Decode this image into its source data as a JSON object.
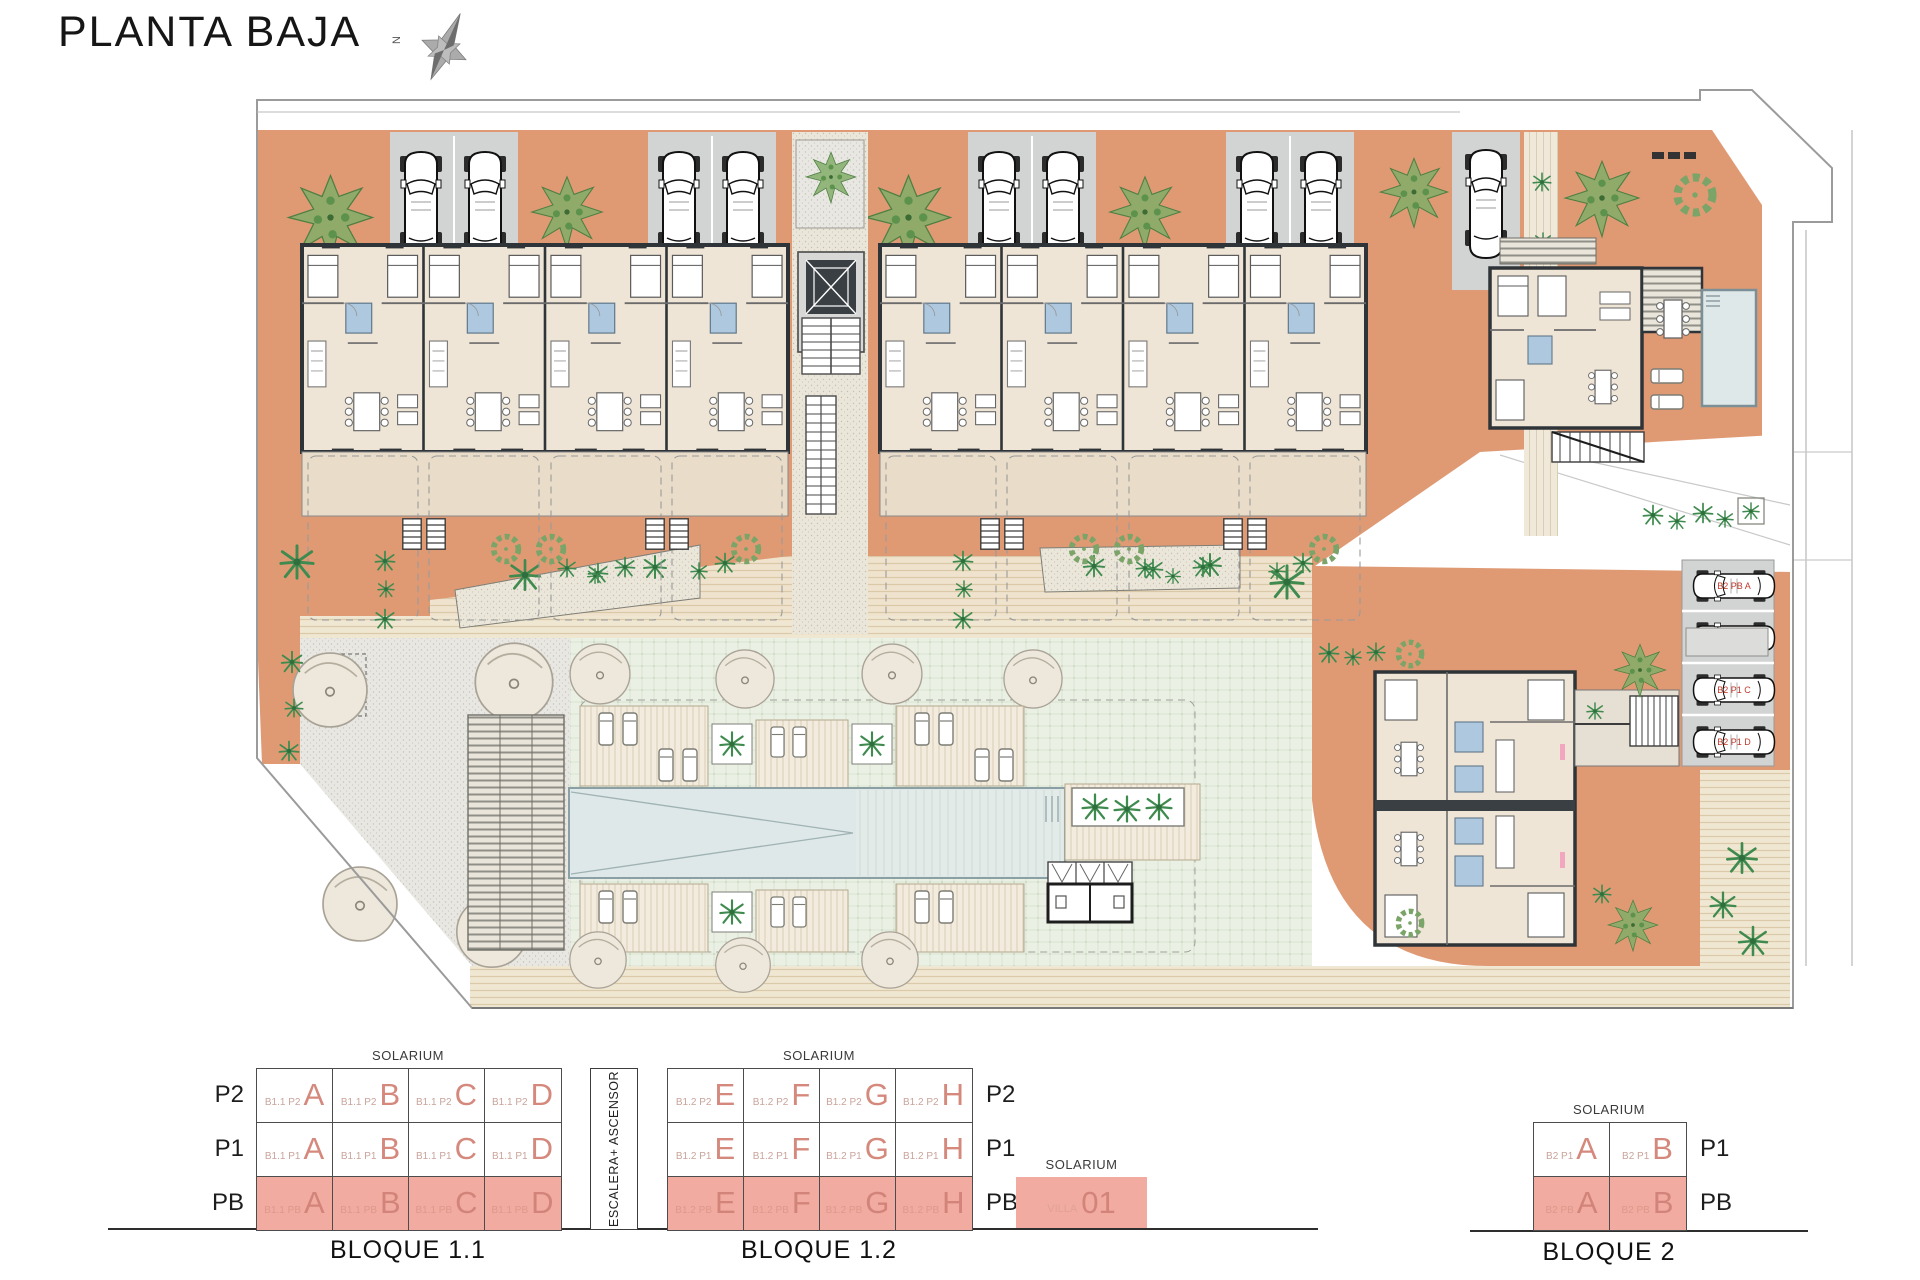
{
  "title": "PLANTA BAJA",
  "compass": {
    "north_label": "N"
  },
  "schematics": {
    "solarium_label": "SOLARIUM",
    "bloque11": {
      "name": "BLOQUE 1.1",
      "prefix": "B1.1",
      "floors": [
        "P2",
        "P1",
        "PB"
      ],
      "units": [
        "A",
        "B",
        "C",
        "D"
      ]
    },
    "escalera_label": "ESCALERA+ ASCENSOR",
    "bloque12": {
      "name": "BLOQUE 1.2",
      "prefix": "B1.2",
      "floors": [
        "P2",
        "P1",
        "PB"
      ],
      "units": [
        "E",
        "F",
        "G",
        "H"
      ]
    },
    "villa": {
      "floor_label": "PB",
      "name_small": "VILLA",
      "name_big": "01"
    },
    "bloque2": {
      "name": "BLOQUE 2",
      "prefix": "B2",
      "floors": [
        "P1",
        "PB"
      ],
      "units": [
        "A",
        "B"
      ]
    }
  },
  "plan": {
    "parking_labels": [
      "B2 PB A",
      "B2 PB B",
      "B2 P1 C",
      "B2 P1 D"
    ]
  },
  "colors": {
    "terrace_orange": "#DF9A74",
    "building_fill": "#EFE5D6",
    "wall_dark": "#2F3438",
    "parking_gray": "#D2D3D3",
    "pool_blue": "#DFE8E8",
    "lawn_green": "#EAF0E4",
    "bath_blue": "#AEC9DF",
    "salmon_fill": "#F1ABA0",
    "salmon_letter": "#D5887C",
    "label_red": "#C0392B"
  }
}
